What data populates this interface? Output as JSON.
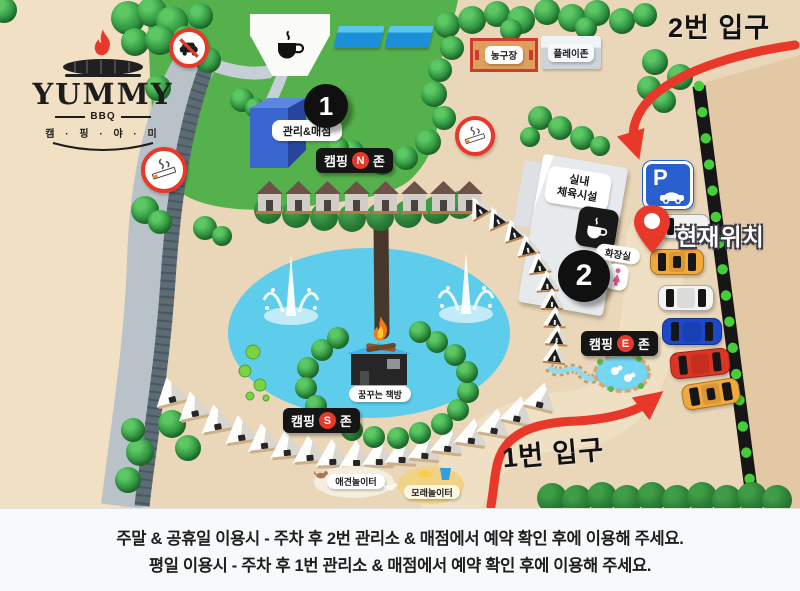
{
  "title": "캠핑야미 시설 안내도",
  "brand": {
    "name": "YUMMY",
    "sub": "BBQ",
    "hangul": "캠 · 핑 · 야 · 미"
  },
  "entrances": {
    "entrance2": "2번 입구",
    "entrance1": "1번 입구"
  },
  "current_location": "현재위치",
  "zones": {
    "n": {
      "prefix": "캠핑",
      "letter": "N",
      "suffix": "존"
    },
    "e": {
      "prefix": "캠핑",
      "letter": "E",
      "suffix": "존"
    },
    "s": {
      "prefix": "캠핑",
      "letter": "S",
      "suffix": "존"
    }
  },
  "places": {
    "management": "관리&매점",
    "indoor_gym_line1": "실내",
    "indoor_gym_line2": "체육시설",
    "restroom": "화장실",
    "book_house": "꿈꾸는 책방",
    "basketball": "농구장",
    "playzone": "플레이존",
    "dog_playground": "애견놀이터",
    "sand_playground": "모래놀이터"
  },
  "markers": {
    "point1": "1",
    "point2": "2",
    "parking": "P"
  },
  "notice": {
    "line1": "주말 & 공휴일 이용시 - 주차 후 2번 관리소 & 매점에서 예약 확인 후에 이용해 주세요.",
    "line2": "평일 이용시 - 주차 후 1번 관리소 & 매점에서 예약 확인 후에 이용해 주세요."
  },
  "icons": {
    "flame-icon": "bbq flame",
    "grill-icon": "bbq grill",
    "coffee-cup-icon": "coffee cup",
    "no-car-icon": "car prohibited sign",
    "smoking-icon": "cigarette sign",
    "parking-icon": "parking P with car",
    "location-pin-icon": "current location pin",
    "restroom-female-icon": "female figure",
    "campfire-icon": "campfire",
    "fountain-icon": "fountain",
    "duck-icon": "ducks in pond",
    "dog-icon": "dog",
    "sand-bucket-icon": "sand bucket"
  },
  "colors": {
    "ground": "#ead6b8",
    "ground_light": "#f2e2c6",
    "ground_dark": "#e3c8a6",
    "grass": "#55b14b",
    "pond": "#5ecdeb",
    "accent_red": "#e8382a",
    "badge_black": "#151515",
    "parking_blue": "#2a5fd0",
    "building_blue": "#3a66d0",
    "taxi_orange": "#f2a93b",
    "car_red": "#dd3524",
    "car_blue": "#1d49c8",
    "hedge_dot_green": "#46ce3a",
    "road_gray": "#b9c2c9"
  }
}
